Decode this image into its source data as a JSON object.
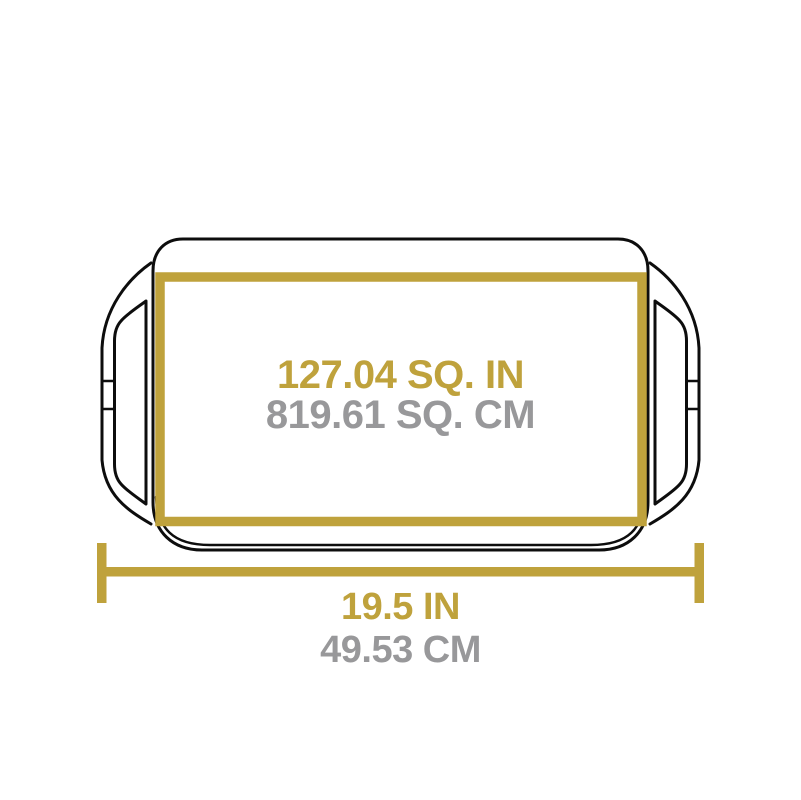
{
  "diagram": {
    "kind": "product-dimension-diagram",
    "subject": "griddle-top-view",
    "colors": {
      "accent_gold": "#bfa23c",
      "secondary_gray": "#98989a",
      "outline_black": "#0d0d0d",
      "background": "#ffffff"
    },
    "surface_area": {
      "imperial": "127.04 SQ. IN",
      "metric": "819.61 SQ. CM"
    },
    "overall_width": {
      "imperial": "19.5 IN",
      "metric": "49.53 CM"
    }
  }
}
